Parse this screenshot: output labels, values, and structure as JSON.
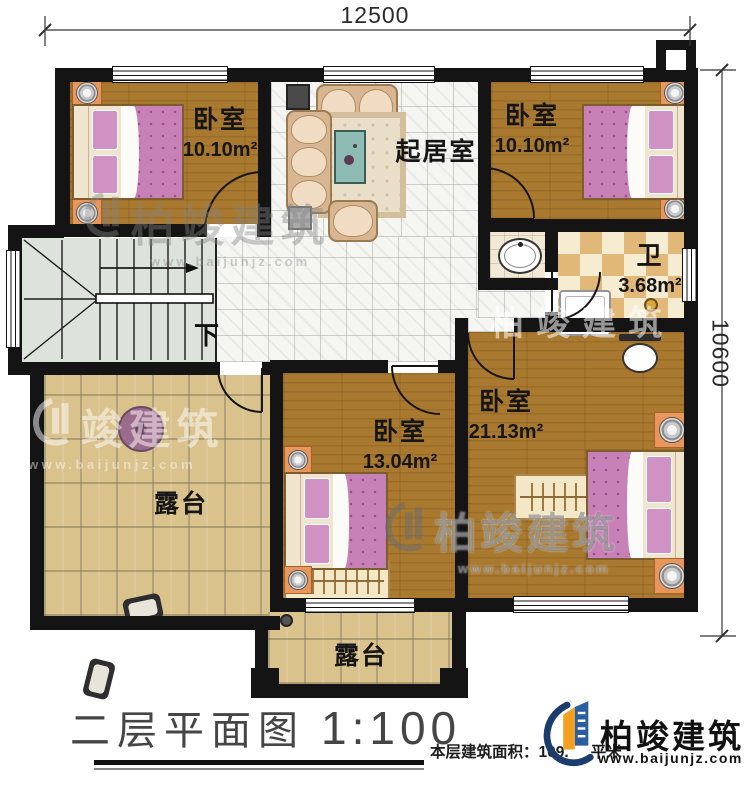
{
  "plan": {
    "title": "二层平面图",
    "scale": "1:100",
    "area_label": "本层建筑面积：",
    "area_value": "109.",
    "area_unit": "平米"
  },
  "dimensions": {
    "width_top": "12500",
    "height_right": "10600"
  },
  "rooms": [
    {
      "name": "卧室",
      "area": "10.10m²"
    },
    {
      "name": "起居室",
      "area": ""
    },
    {
      "name": "卧室",
      "area": "10.10m²"
    },
    {
      "name": "卫",
      "area": "3.68m²"
    },
    {
      "name": "卧室",
      "area": "21.13m²"
    },
    {
      "name": "卧室",
      "area": "13.04m²"
    },
    {
      "name": "露台",
      "area": ""
    },
    {
      "name": "露台",
      "area": ""
    }
  ],
  "stairs": {
    "direction_label": "下"
  },
  "watermark": {
    "brand": "柏竣建筑",
    "brand_short": "竣建筑",
    "url": "www.baijunjz.com"
  },
  "logo": {
    "brand": "柏竣建筑",
    "url": "www.baijunjz.com"
  },
  "colors": {
    "wall": "#141414",
    "wood_floor": "#a9792f",
    "terrace_stone": "#d9c28c",
    "bed_pink": "#c781b7",
    "logo_blue": "#1d3c6e",
    "logo_orange": "#f49f1f"
  }
}
